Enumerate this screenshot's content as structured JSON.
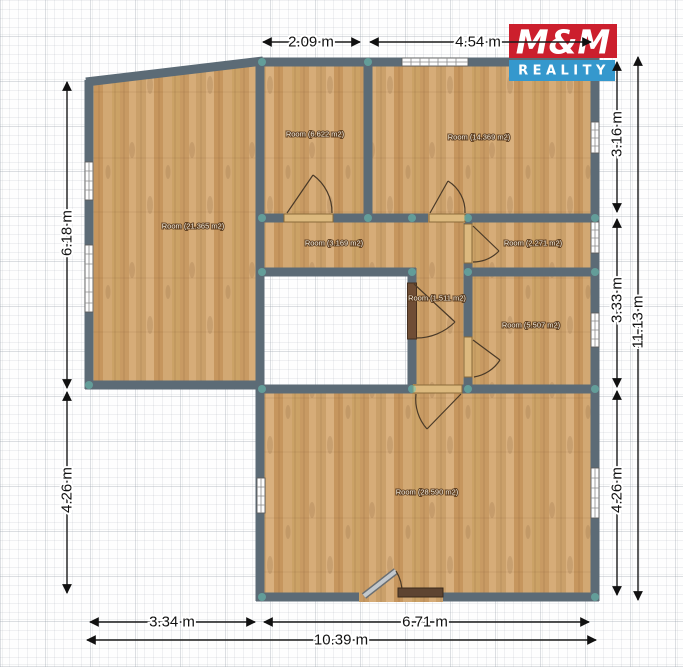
{
  "plan": {
    "rooms": [
      {
        "id": "room-21-365",
        "label": "Room (21.365 m2)"
      },
      {
        "id": "room-6-622",
        "label": "Room (6.622 m2)"
      },
      {
        "id": "room-14-369",
        "label": "Room (14.369 m2)"
      },
      {
        "id": "room-3-169",
        "label": "Room (3.169 m2)"
      },
      {
        "id": "room-2-271",
        "label": "Room (2.271 m2)"
      },
      {
        "id": "room-1-511",
        "label": "Room (1.511 m2)"
      },
      {
        "id": "room-5-507",
        "label": "Room (5.507 m2)"
      },
      {
        "id": "room-28-590",
        "label": "Room (28.590 m2)"
      }
    ],
    "dimensions": {
      "top": [
        {
          "label": "2.09 m"
        },
        {
          "label": "4.54 m"
        }
      ],
      "left": [
        {
          "label": "6.18 m"
        },
        {
          "label": "4.26 m"
        }
      ],
      "right": [
        {
          "label": "3.16 m"
        },
        {
          "label": "3.33 m"
        },
        {
          "label": "4.26 m"
        },
        {
          "label": "11.13 m"
        }
      ],
      "bottom": [
        {
          "label": "3.34 m"
        },
        {
          "label": "6.71 m"
        },
        {
          "label": "10.39 m"
        }
      ]
    },
    "colors": {
      "wall": "#5c6b76",
      "floor": "#cfa36e",
      "window": "#ffffff",
      "joint_dot": "#6ac6b6"
    }
  },
  "logo": {
    "title": "M&M",
    "subtitle": "REALITY",
    "red": "#cc1f2d",
    "blue": "#3598cd"
  }
}
